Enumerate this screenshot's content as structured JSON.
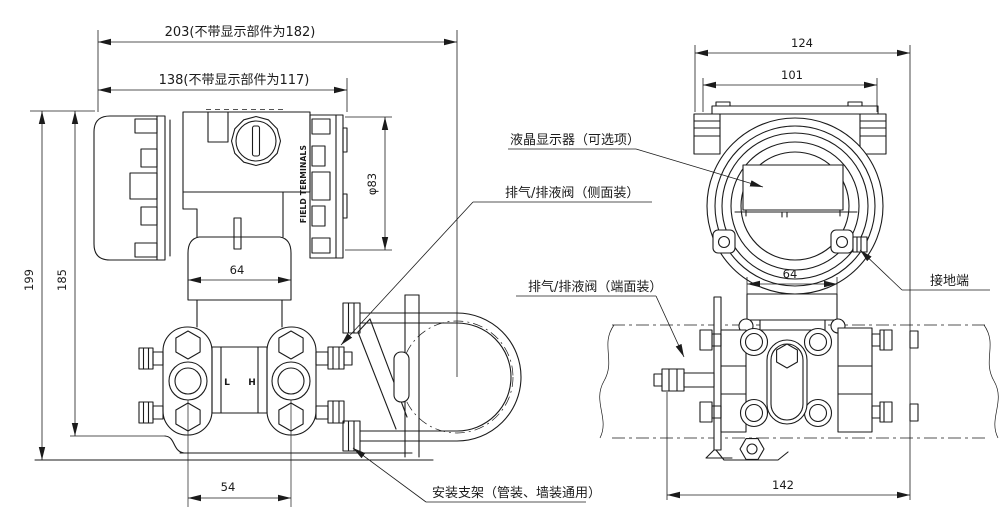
{
  "colors": {
    "line": "#1b1b1b",
    "background": "#ffffff"
  },
  "front_view": {
    "dims": {
      "total_length": "203(不带显示部件为182)",
      "housing_length": "138(不带显示部件为117)",
      "overall_height": "199",
      "flange_height": "185",
      "cover_diameter": "φ83",
      "neck_width": "64",
      "port_spacing": "54"
    },
    "markings": {
      "field_terminals": "FIELD TERMINALS",
      "low_side": "L",
      "high_side": "H"
    }
  },
  "side_view": {
    "dims": {
      "overall_width": "124",
      "housing_width": "101",
      "neck_width": "64",
      "manifold_width": "142"
    }
  },
  "callouts": {
    "lcd": "液晶显示器（可选项）",
    "vent_side": "排气/排液阀（侧面装）",
    "vent_end": "排气/排液阀（端面装）",
    "ground": "接地端",
    "bracket": "安装支架（管装、墙装通用）"
  }
}
